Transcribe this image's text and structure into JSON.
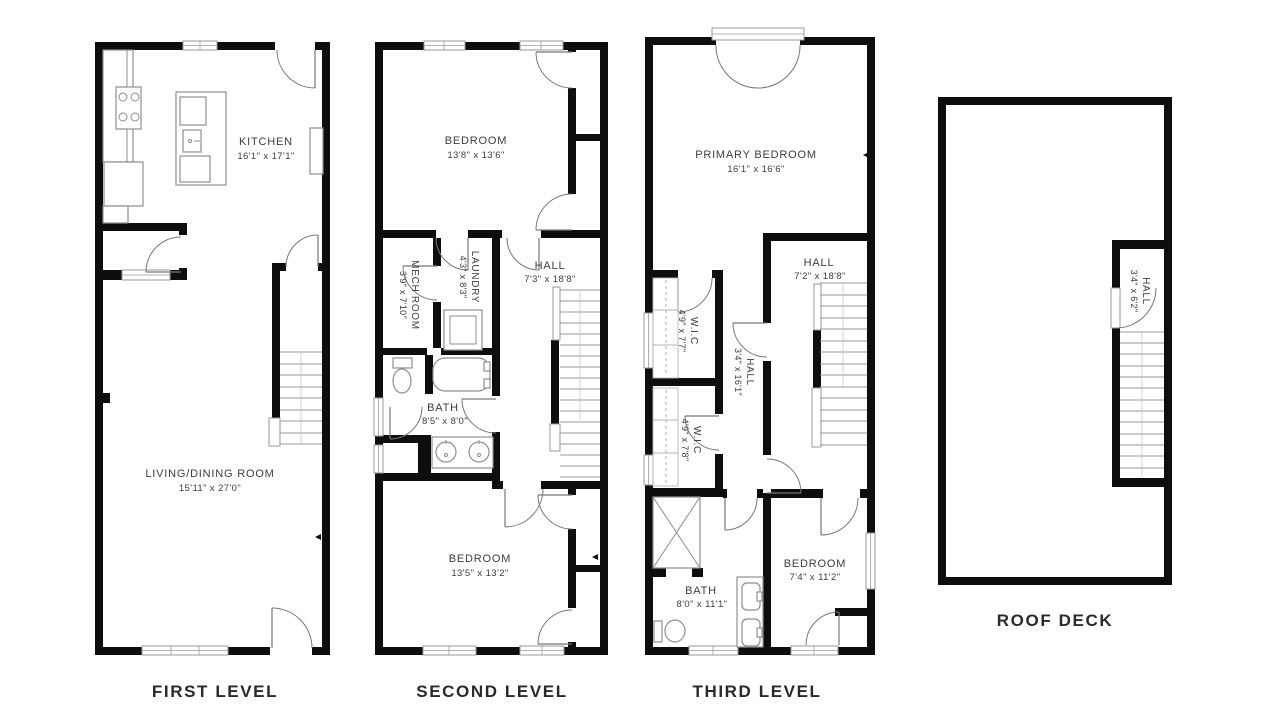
{
  "page": {
    "background": "#ffffff"
  },
  "colors": {
    "wall": "#0e0e0e",
    "fixture": "#8f8f8f",
    "door": "#777777",
    "label": "#3d3d3d",
    "level_label": "#2a2a2a"
  },
  "levels": [
    {
      "label": "FIRST LEVEL",
      "rooms": [
        {
          "name": "KITCHEN",
          "dims": "16'1\" x 17'1\""
        },
        {
          "name": "LIVING/DINING ROOM",
          "dims": "15'11\" x 27'0\""
        }
      ]
    },
    {
      "label": "SECOND LEVEL",
      "rooms": [
        {
          "name": "BEDROOM",
          "dims": "13'8\" x 13'6\""
        },
        {
          "name": "MECH ROOM",
          "dims": "3'9\" x 7'10\""
        },
        {
          "name": "LAUNDRY",
          "dims": "4'3\" x 8'3\""
        },
        {
          "name": "HALL",
          "dims": "7'3\" x 18'8\""
        },
        {
          "name": "BATH",
          "dims": "8'5\" x 8'0\""
        },
        {
          "name": "BEDROOM",
          "dims": "13'5\" x 13'2\""
        }
      ]
    },
    {
      "label": "THIRD LEVEL",
      "rooms": [
        {
          "name": "PRIMARY BEDROOM",
          "dims": "16'1\" x 16'6\""
        },
        {
          "name": "HALL",
          "dims": "7'2\" x 18'8\""
        },
        {
          "name": "W.I.C",
          "dims": "4'9\" x 7'7\""
        },
        {
          "name": "HALL",
          "dims": "3'4\" x 16'1\""
        },
        {
          "name": "W.I.C",
          "dims": "4'9\" x 7'8\""
        },
        {
          "name": "BATH",
          "dims": "8'0\" x 11'1\""
        },
        {
          "name": "BEDROOM",
          "dims": "7'4\" x 11'2\""
        }
      ]
    },
    {
      "label": "ROOF DECK",
      "rooms": [
        {
          "name": "HALL",
          "dims": "3'4\" x 6'2\""
        }
      ]
    }
  ]
}
